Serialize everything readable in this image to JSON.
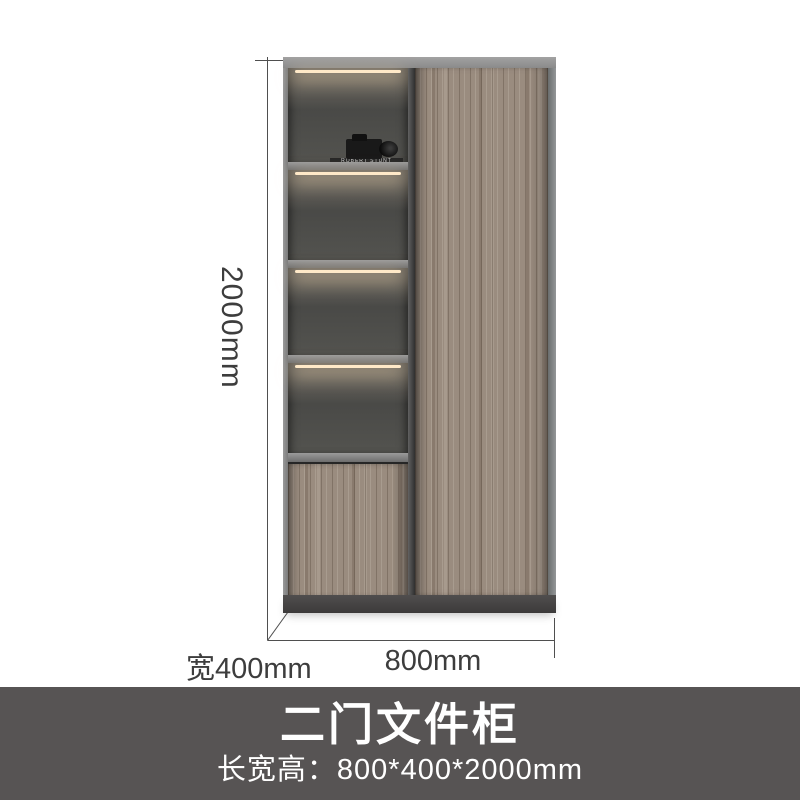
{
  "page": {
    "background": "#ffffff"
  },
  "annotations": {
    "height_label": "2000mm",
    "depth_label": "宽400mm",
    "width_label": "800mm",
    "line_color": "#4f4f4f",
    "text_color": "#3d3d3d"
  },
  "banner": {
    "title": "二门文件柜",
    "subtitle": "长宽高：800*400*2000mm",
    "background": "#575454",
    "text_color": "#ffffff"
  },
  "cabinet": {
    "frame_color": "#8a8a8a",
    "interior_color": "#4a4a48",
    "shelf_color": "#7e7e7e",
    "wood_color": "#9a8c7f",
    "base_color": "#474545",
    "led_color": "#ffe8c6",
    "decor": {
      "book_spine_top": "ROBERT STUNT",
      "book_spine_bottom": "H G M A",
      "binder_count": 5,
      "binder_color": "#7c8a77",
      "strap_color": "#ad5c2b"
    }
  }
}
